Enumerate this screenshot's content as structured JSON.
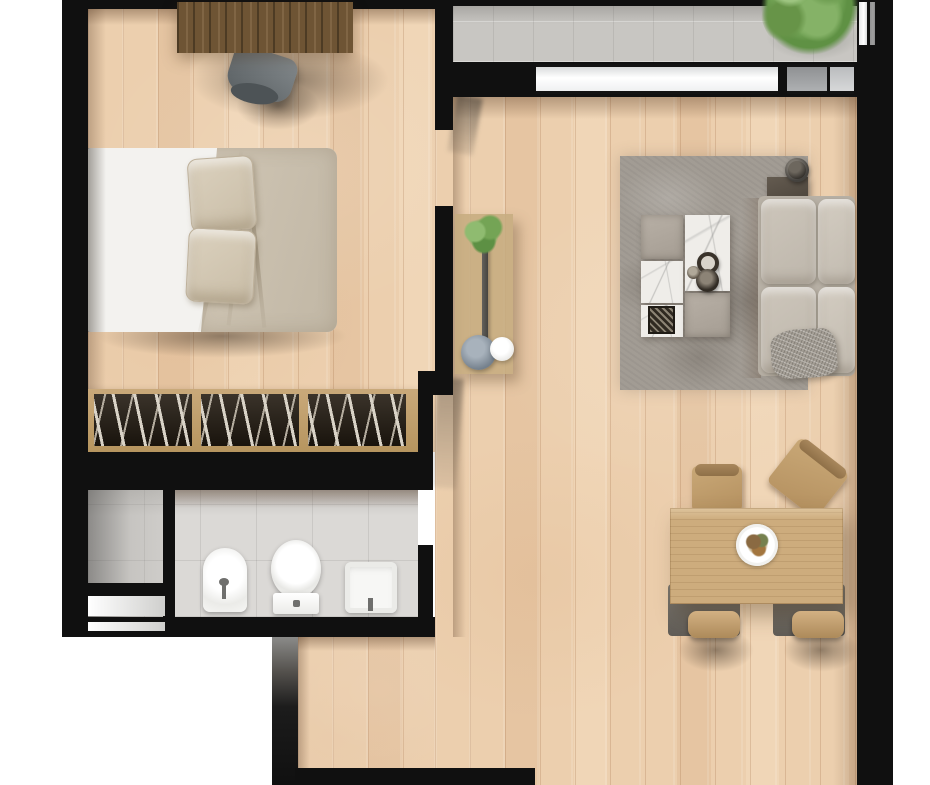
{
  "scene": {
    "type": "apartment-floor-plan",
    "view": "top-down-3d-render",
    "background": "#ffffff"
  },
  "colors": {
    "wall": "#101010",
    "wood": "#eccfae",
    "bath-tile": "#dbd9d6",
    "balcony-tile": "#c8c6c2",
    "rug": "#a29c94",
    "sofa": "#b7b0a5",
    "duvet": "#d0c6b5",
    "pillow": "#dbd1be",
    "sheet": "#f3f2ef",
    "desk": "#6e5434",
    "table": "#cdac7d",
    "chairwood": "#c9a877",
    "fixture": "#f8f8f6",
    "shelf": "#c9a97a",
    "books": "#241c12",
    "marble": "#efede9",
    "fabric": "#b8b0a6"
  },
  "rooms": [
    {
      "id": "bedroom",
      "label": "Bedroom",
      "floor": "wood"
    },
    {
      "id": "bathroom",
      "label": "Bathroom",
      "floor": "tile"
    },
    {
      "id": "hallway",
      "label": "Hallway",
      "floor": "wood"
    },
    {
      "id": "living-dining",
      "label": "Living / dining room",
      "floor": "wood"
    },
    {
      "id": "balcony",
      "label": "Balcony",
      "floor": "tile"
    },
    {
      "id": "entry",
      "label": "Entry",
      "floor": "wood"
    }
  ],
  "furniture": {
    "desk": {
      "label": "Desk"
    },
    "desk_chair": {
      "label": "Desk chair"
    },
    "bed": {
      "label": "Double bed",
      "pillows": 2
    },
    "bookshelf": {
      "label": "Bookshelf",
      "compartments": 3
    },
    "bidet": {
      "label": "Bidet"
    },
    "toilet": {
      "label": "Toilet"
    },
    "washbasin": {
      "label": "Washbasin"
    },
    "shower": {
      "label": "Shower"
    },
    "console": {
      "label": "Console table with plant"
    },
    "rug": {
      "label": "Area rug"
    },
    "coffee_table": {
      "label": "Modular coffee table"
    },
    "sofa": {
      "label": "Sofa",
      "seat_cushions": 2,
      "back_cushions": 2
    },
    "side_table": {
      "label": "Side table with lamp"
    },
    "dining_table": {
      "label": "Dining table"
    },
    "dining_chair": {
      "label": "Dining chair",
      "count": 4
    },
    "plate": {
      "label": "Place setting"
    },
    "tree": {
      "label": "Balcony plant"
    },
    "window": {
      "label": "Window band",
      "segments": 3
    }
  }
}
